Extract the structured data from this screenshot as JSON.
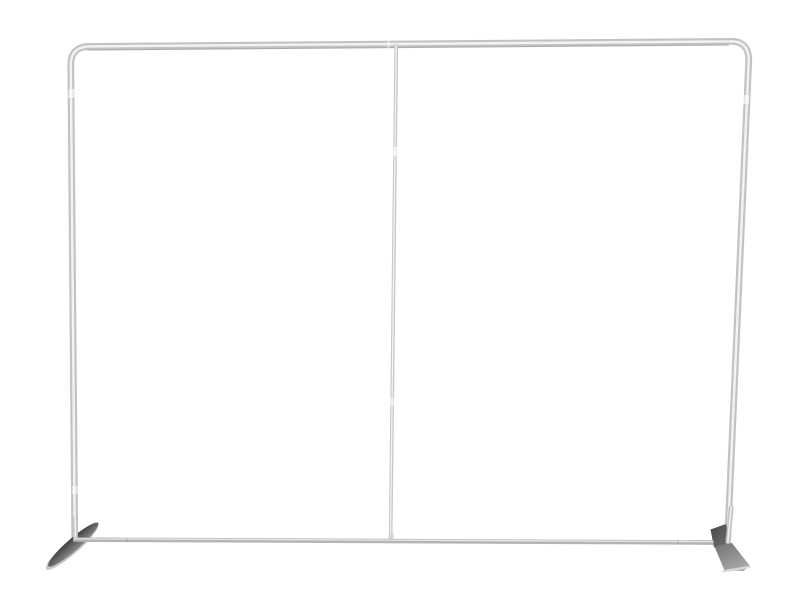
{
  "scene": {
    "type": "product-photo",
    "subject": "Silver aluminum tube frame for a straight tension-fabric backdrop display, with rounded top corners, a thin center support pole, and two flat angled stabilizing feet, on a plain white background",
    "background_color": "#ffffff"
  },
  "colors": {
    "background": "#ffffff",
    "tube_base": "#c3c3c3",
    "tube_highlight": "#f3f3f3",
    "tube_shadow": "#a0a0a0",
    "bottom_bar": "#b4b4b4",
    "bottom_bar_highlight": "#e9e9e9",
    "center_pole": "#c9c9c9",
    "center_pole_highlight": "#f5f5f5",
    "joint_band": "#ffffff",
    "seam_tick": "#9a9a9a",
    "foot_dark": "#3f3f3f",
    "foot_mid": "#8a8a8a",
    "foot_under_light": "#c8c8c8",
    "block_dark": "#474747",
    "block_light": "#6e6e6e",
    "plate_dark": "#6f6f6f",
    "plate_light": "#a8a8a8",
    "plate_edge_highlight": "#d8d8d8",
    "pole_fitting": "#d2d2d2"
  },
  "parts": {
    "left_upright": "left upright tube",
    "top_crossbar": "top crossbar tube",
    "right_upright": "right upright tube",
    "bottom_crossbar": "bottom crossbar tube",
    "center_pole": "center support pole",
    "left_foot": "left blade foot",
    "right_foot": "right plate foot",
    "tube_joints": "push-fit tube segment joints"
  }
}
